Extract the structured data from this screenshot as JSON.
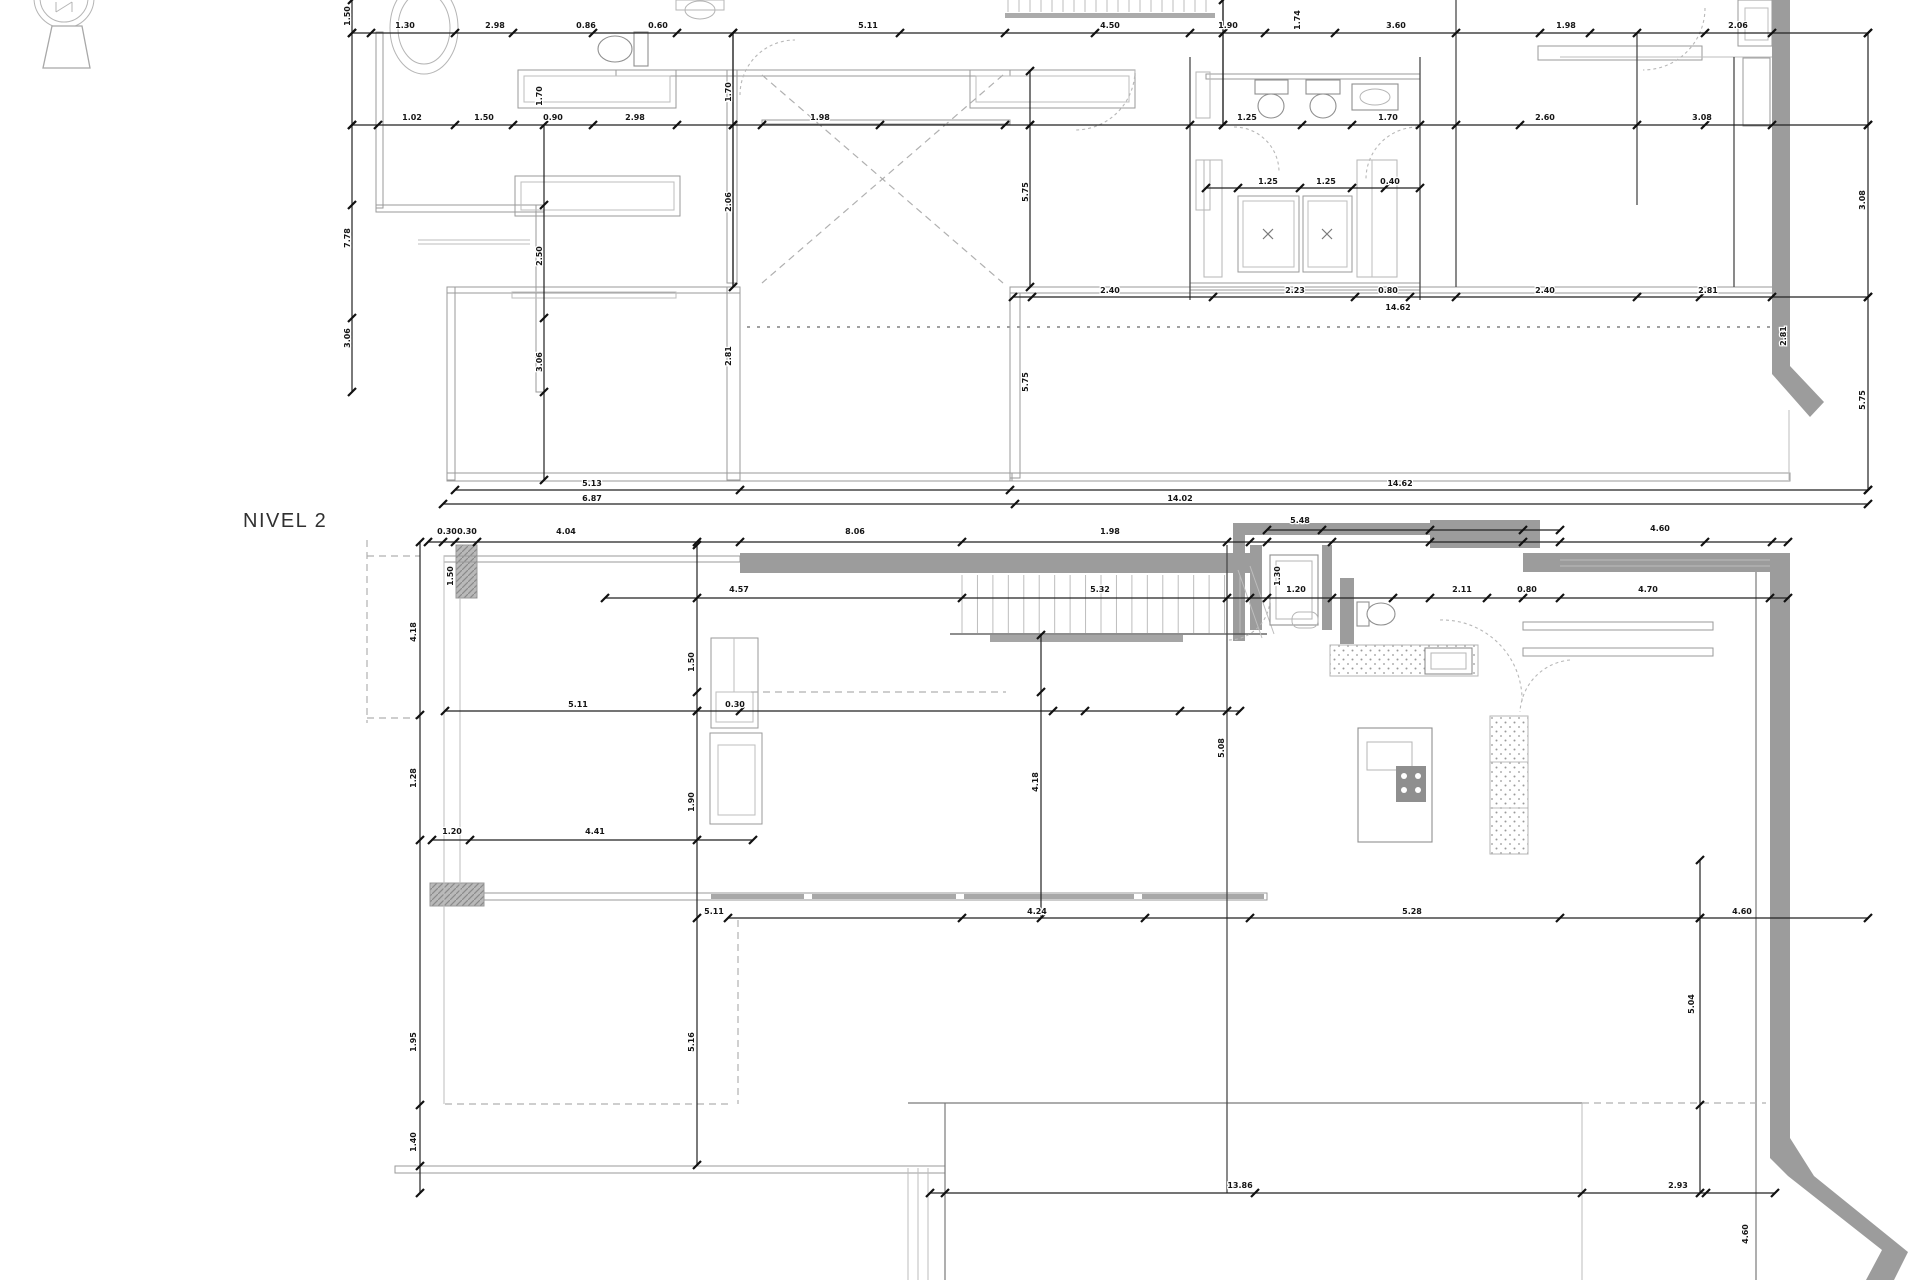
{
  "drawing": {
    "level_label": "NIVEL 2",
    "type_note": "architectural floor plans, two levels, scanned CAD sheet"
  },
  "icons": [
    {
      "name": "north-indicator-icon"
    }
  ],
  "colors": {
    "background": "#ffffff",
    "wall_gray": "#9c9c9c",
    "line_dark": "#222222",
    "line_light": "#b0b0b0"
  },
  "dimension_labels": [
    {
      "t": "1.30",
      "x": 405,
      "y": 28
    },
    {
      "t": "2.98",
      "x": 495,
      "y": 28
    },
    {
      "t": "0.86",
      "x": 586,
      "y": 28
    },
    {
      "t": "0.60",
      "x": 658,
      "y": 28
    },
    {
      "t": "5.11",
      "x": 868,
      "y": 28
    },
    {
      "t": "4.50",
      "x": 1110,
      "y": 28
    },
    {
      "t": "1.90",
      "x": 1228,
      "y": 28
    },
    {
      "t": "3.60",
      "x": 1396,
      "y": 28
    },
    {
      "t": "1.98",
      "x": 1566,
      "y": 28
    },
    {
      "t": "2.06",
      "x": 1738,
      "y": 28
    },
    {
      "t": "1.02",
      "x": 412,
      "y": 120
    },
    {
      "t": "1.50",
      "x": 484,
      "y": 120
    },
    {
      "t": "0.90",
      "x": 553,
      "y": 120
    },
    {
      "t": "2.98",
      "x": 635,
      "y": 120
    },
    {
      "t": "1.98",
      "x": 820,
      "y": 120
    },
    {
      "t": "1.25",
      "x": 1247,
      "y": 120
    },
    {
      "t": "1.70",
      "x": 1388,
      "y": 120
    },
    {
      "t": "2.60",
      "x": 1545,
      "y": 120
    },
    {
      "t": "3.08",
      "x": 1702,
      "y": 120
    },
    {
      "t": "1.25",
      "x": 1268,
      "y": 184
    },
    {
      "t": "1.25",
      "x": 1326,
      "y": 184
    },
    {
      "t": "0.40",
      "x": 1390,
      "y": 184
    },
    {
      "t": "2.40",
      "x": 1110,
      "y": 293
    },
    {
      "t": "2.23",
      "x": 1295,
      "y": 293
    },
    {
      "t": "0.80",
      "x": 1388,
      "y": 293
    },
    {
      "t": "2.40",
      "x": 1545,
      "y": 293
    },
    {
      "t": "2.81",
      "x": 1708,
      "y": 293
    },
    {
      "t": "14.62",
      "x": 1398,
      "y": 310
    },
    {
      "t": "5.13",
      "x": 592,
      "y": 486
    },
    {
      "t": "14.62",
      "x": 1400,
      "y": 486
    },
    {
      "t": "6.87",
      "x": 592,
      "y": 501
    },
    {
      "t": "14.02",
      "x": 1180,
      "y": 501
    },
    {
      "t": "1.50",
      "x": 350,
      "y": 16,
      "r": 1
    },
    {
      "t": "7.78",
      "x": 350,
      "y": 238,
      "r": 1
    },
    {
      "t": "3.06",
      "x": 350,
      "y": 338,
      "r": 1
    },
    {
      "t": "1.70",
      "x": 542,
      "y": 96,
      "r": 1
    },
    {
      "t": "2.50",
      "x": 542,
      "y": 256,
      "r": 1
    },
    {
      "t": "3.06",
      "x": 542,
      "y": 362,
      "r": 1
    },
    {
      "t": "1.70",
      "x": 731,
      "y": 92,
      "r": 1
    },
    {
      "t": "2.06",
      "x": 731,
      "y": 202,
      "r": 1
    },
    {
      "t": "2.81",
      "x": 731,
      "y": 356,
      "r": 1
    },
    {
      "t": "5.75",
      "x": 1028,
      "y": 192,
      "r": 1
    },
    {
      "t": "5.75",
      "x": 1028,
      "y": 382,
      "r": 1
    },
    {
      "t": "1.74",
      "x": 1300,
      "y": 20,
      "r": 1
    },
    {
      "t": "3.08",
      "x": 1865,
      "y": 200,
      "r": 1
    },
    {
      "t": "5.75",
      "x": 1865,
      "y": 400,
      "r": 1
    },
    {
      "t": "2.81",
      "x": 1786,
      "y": 336,
      "r": 1
    },
    {
      "t": "0.30",
      "x": 447,
      "y": 534
    },
    {
      "t": "0.30",
      "x": 467,
      "y": 534
    },
    {
      "t": "4.04",
      "x": 566,
      "y": 534
    },
    {
      "t": "8.06",
      "x": 855,
      "y": 534
    },
    {
      "t": "1.98",
      "x": 1110,
      "y": 534
    },
    {
      "t": "5.48",
      "x": 1300,
      "y": 523
    },
    {
      "t": "4.60",
      "x": 1660,
      "y": 531
    },
    {
      "t": "4.57",
      "x": 739,
      "y": 592
    },
    {
      "t": "5.32",
      "x": 1100,
      "y": 592
    },
    {
      "t": "1.20",
      "x": 1296,
      "y": 592
    },
    {
      "t": "2.11",
      "x": 1462,
      "y": 592
    },
    {
      "t": "0.80",
      "x": 1527,
      "y": 592
    },
    {
      "t": "4.70",
      "x": 1648,
      "y": 592
    },
    {
      "t": "5.11",
      "x": 578,
      "y": 707
    },
    {
      "t": "0.30",
      "x": 735,
      "y": 707
    },
    {
      "t": "1.20",
      "x": 452,
      "y": 834
    },
    {
      "t": "4.41",
      "x": 595,
      "y": 834
    },
    {
      "t": "5.11",
      "x": 714,
      "y": 914
    },
    {
      "t": "4.24",
      "x": 1037,
      "y": 914
    },
    {
      "t": "5.28",
      "x": 1412,
      "y": 914
    },
    {
      "t": "4.60",
      "x": 1742,
      "y": 914
    },
    {
      "t": "13.86",
      "x": 1240,
      "y": 1188
    },
    {
      "t": "2.93",
      "x": 1678,
      "y": 1188
    },
    {
      "t": "1.50",
      "x": 453,
      "y": 576,
      "r": 1
    },
    {
      "t": "4.18",
      "x": 416,
      "y": 632,
      "r": 1
    },
    {
      "t": "1.28",
      "x": 416,
      "y": 778,
      "r": 1
    },
    {
      "t": "1.95",
      "x": 416,
      "y": 1042,
      "r": 1
    },
    {
      "t": "1.40",
      "x": 416,
      "y": 1142,
      "r": 1
    },
    {
      "t": "1.50",
      "x": 694,
      "y": 662,
      "r": 1
    },
    {
      "t": "1.90",
      "x": 694,
      "y": 802,
      "r": 1
    },
    {
      "t": "5.16",
      "x": 694,
      "y": 1042,
      "r": 1
    },
    {
      "t": "4.18",
      "x": 1038,
      "y": 782,
      "r": 1
    },
    {
      "t": "5.08",
      "x": 1224,
      "y": 748,
      "r": 1
    },
    {
      "t": "1.30",
      "x": 1280,
      "y": 576,
      "r": 1
    },
    {
      "t": "5.04",
      "x": 1694,
      "y": 1004,
      "r": 1
    },
    {
      "t": "4.60",
      "x": 1748,
      "y": 1234,
      "r": 1
    }
  ]
}
